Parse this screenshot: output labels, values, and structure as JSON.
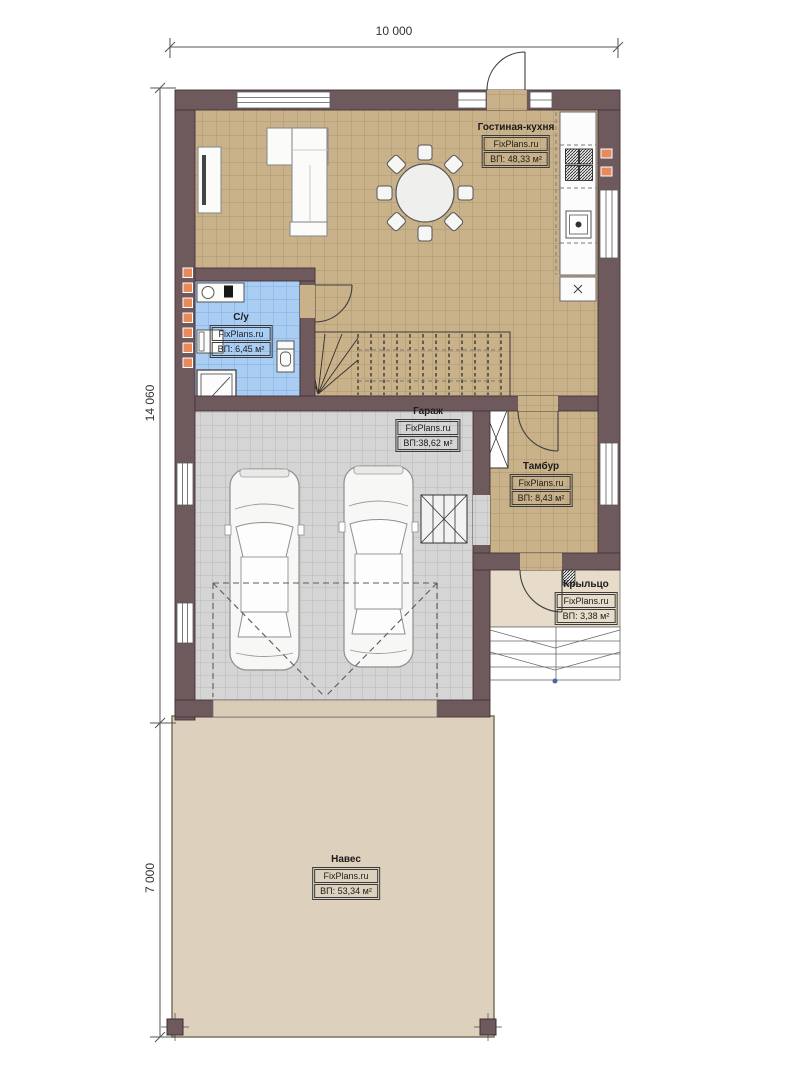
{
  "plan": {
    "title": "floor-plan",
    "dimensions": {
      "top": "10 000",
      "left_upper": "14 060",
      "left_lower": "7 000"
    },
    "rooms": [
      {
        "key": "living-kitchen",
        "name": "Гостиная-кухня",
        "brand": "FixPlans.ru",
        "area": "ВП: 48,33 м²"
      },
      {
        "key": "bathroom",
        "name": "С/у",
        "brand": "FixPlans.ru",
        "area": "ВП: 6,45 м²"
      },
      {
        "key": "garage",
        "name": "Гараж",
        "brand": "FixPlans.ru",
        "area": "ВП:38,62 м²"
      },
      {
        "key": "tambur",
        "name": "Тамбур",
        "brand": "FixPlans.ru",
        "area": "ВП: 8,43 м²"
      },
      {
        "key": "porch",
        "name": "Крыльцо",
        "brand": "FixPlans.ru",
        "area": "ВП: 3,38 м²"
      },
      {
        "key": "canopy",
        "name": "Навес",
        "brand": "FixPlans.ru",
        "area": "ВП: 53,34 м²"
      }
    ],
    "colors": {
      "wall": "#6e595d",
      "floor-living": "#c9b189",
      "floor-bathroom": "#a9cdf3",
      "floor-garage": "#d5d5d5",
      "floor-porch": "#e6dcc9",
      "floor-canopy": "#ddd1bd",
      "vent-accent": "#e98a5e"
    }
  }
}
